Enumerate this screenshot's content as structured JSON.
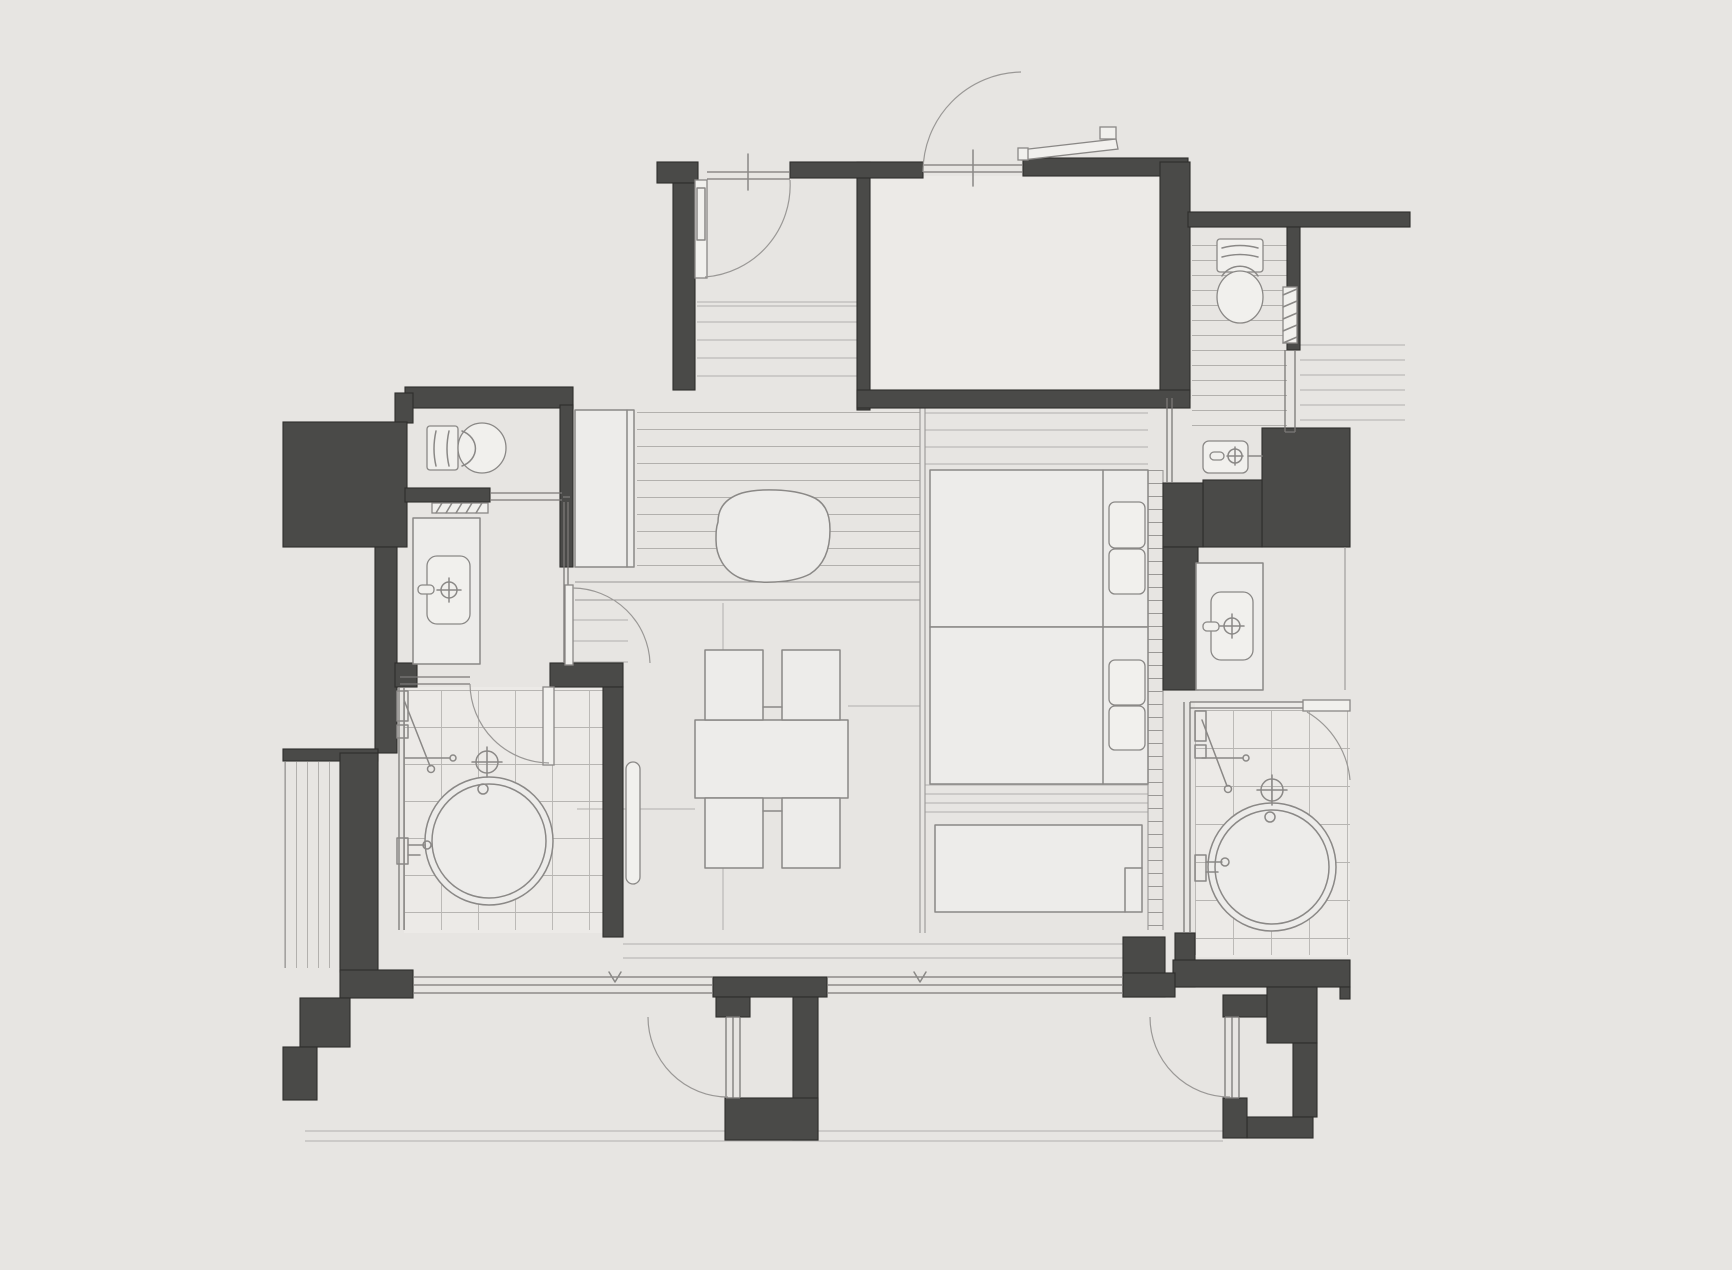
{
  "plan": {
    "kind": "architectural-floor-plan",
    "view": "top-down",
    "canvas": {
      "width": 1732,
      "height": 1270
    }
  },
  "palette": {
    "background": "#e7e5e2",
    "room_fill": "#eceae7",
    "furniture_fill": "#edecea",
    "furniture_bright": "#f1f0ed",
    "wall_fill": "#4a4a48",
    "wall_outline": "#2e2d2b",
    "fixture_line": "#8a8886",
    "floor_line": "#b2b0ad",
    "floor_line_dark": "#9a9896",
    "tile_line": "#b7b5b2",
    "glass_line": "#7b7977",
    "door_arc": "#9a9896"
  },
  "legend": {
    "elements": [
      "entry-door",
      "hall-interior-door",
      "genkan-steps",
      "entry-room",
      "closet-cabinet",
      "toilet-left",
      "pocket-door-left",
      "vanity-sink-left",
      "bathroom-left",
      "round-bathtub-left",
      "floor-drain-left",
      "shower-set-left",
      "landing-steps",
      "landing-door",
      "dining-table",
      "four-chairs",
      "stone-ottoman",
      "leaning-mirror",
      "plank-floor",
      "living-floor-joints",
      "bed-platform",
      "twin-bed-upper",
      "twin-bed-lower",
      "pillows",
      "headboard-ledge",
      "window-bench",
      "toilet-right",
      "pocket-door-right",
      "hand-basin-right",
      "vanity-sink-right",
      "bathroom-right",
      "round-bathtub-right",
      "floor-drain-right",
      "shower-set-right",
      "balcony-window-band",
      "balcony-door-center",
      "balcony-door-right",
      "balcony-edge",
      "corridor-floor-lines",
      "stepped-exterior-wall",
      "vertical-striped-panel"
    ]
  }
}
